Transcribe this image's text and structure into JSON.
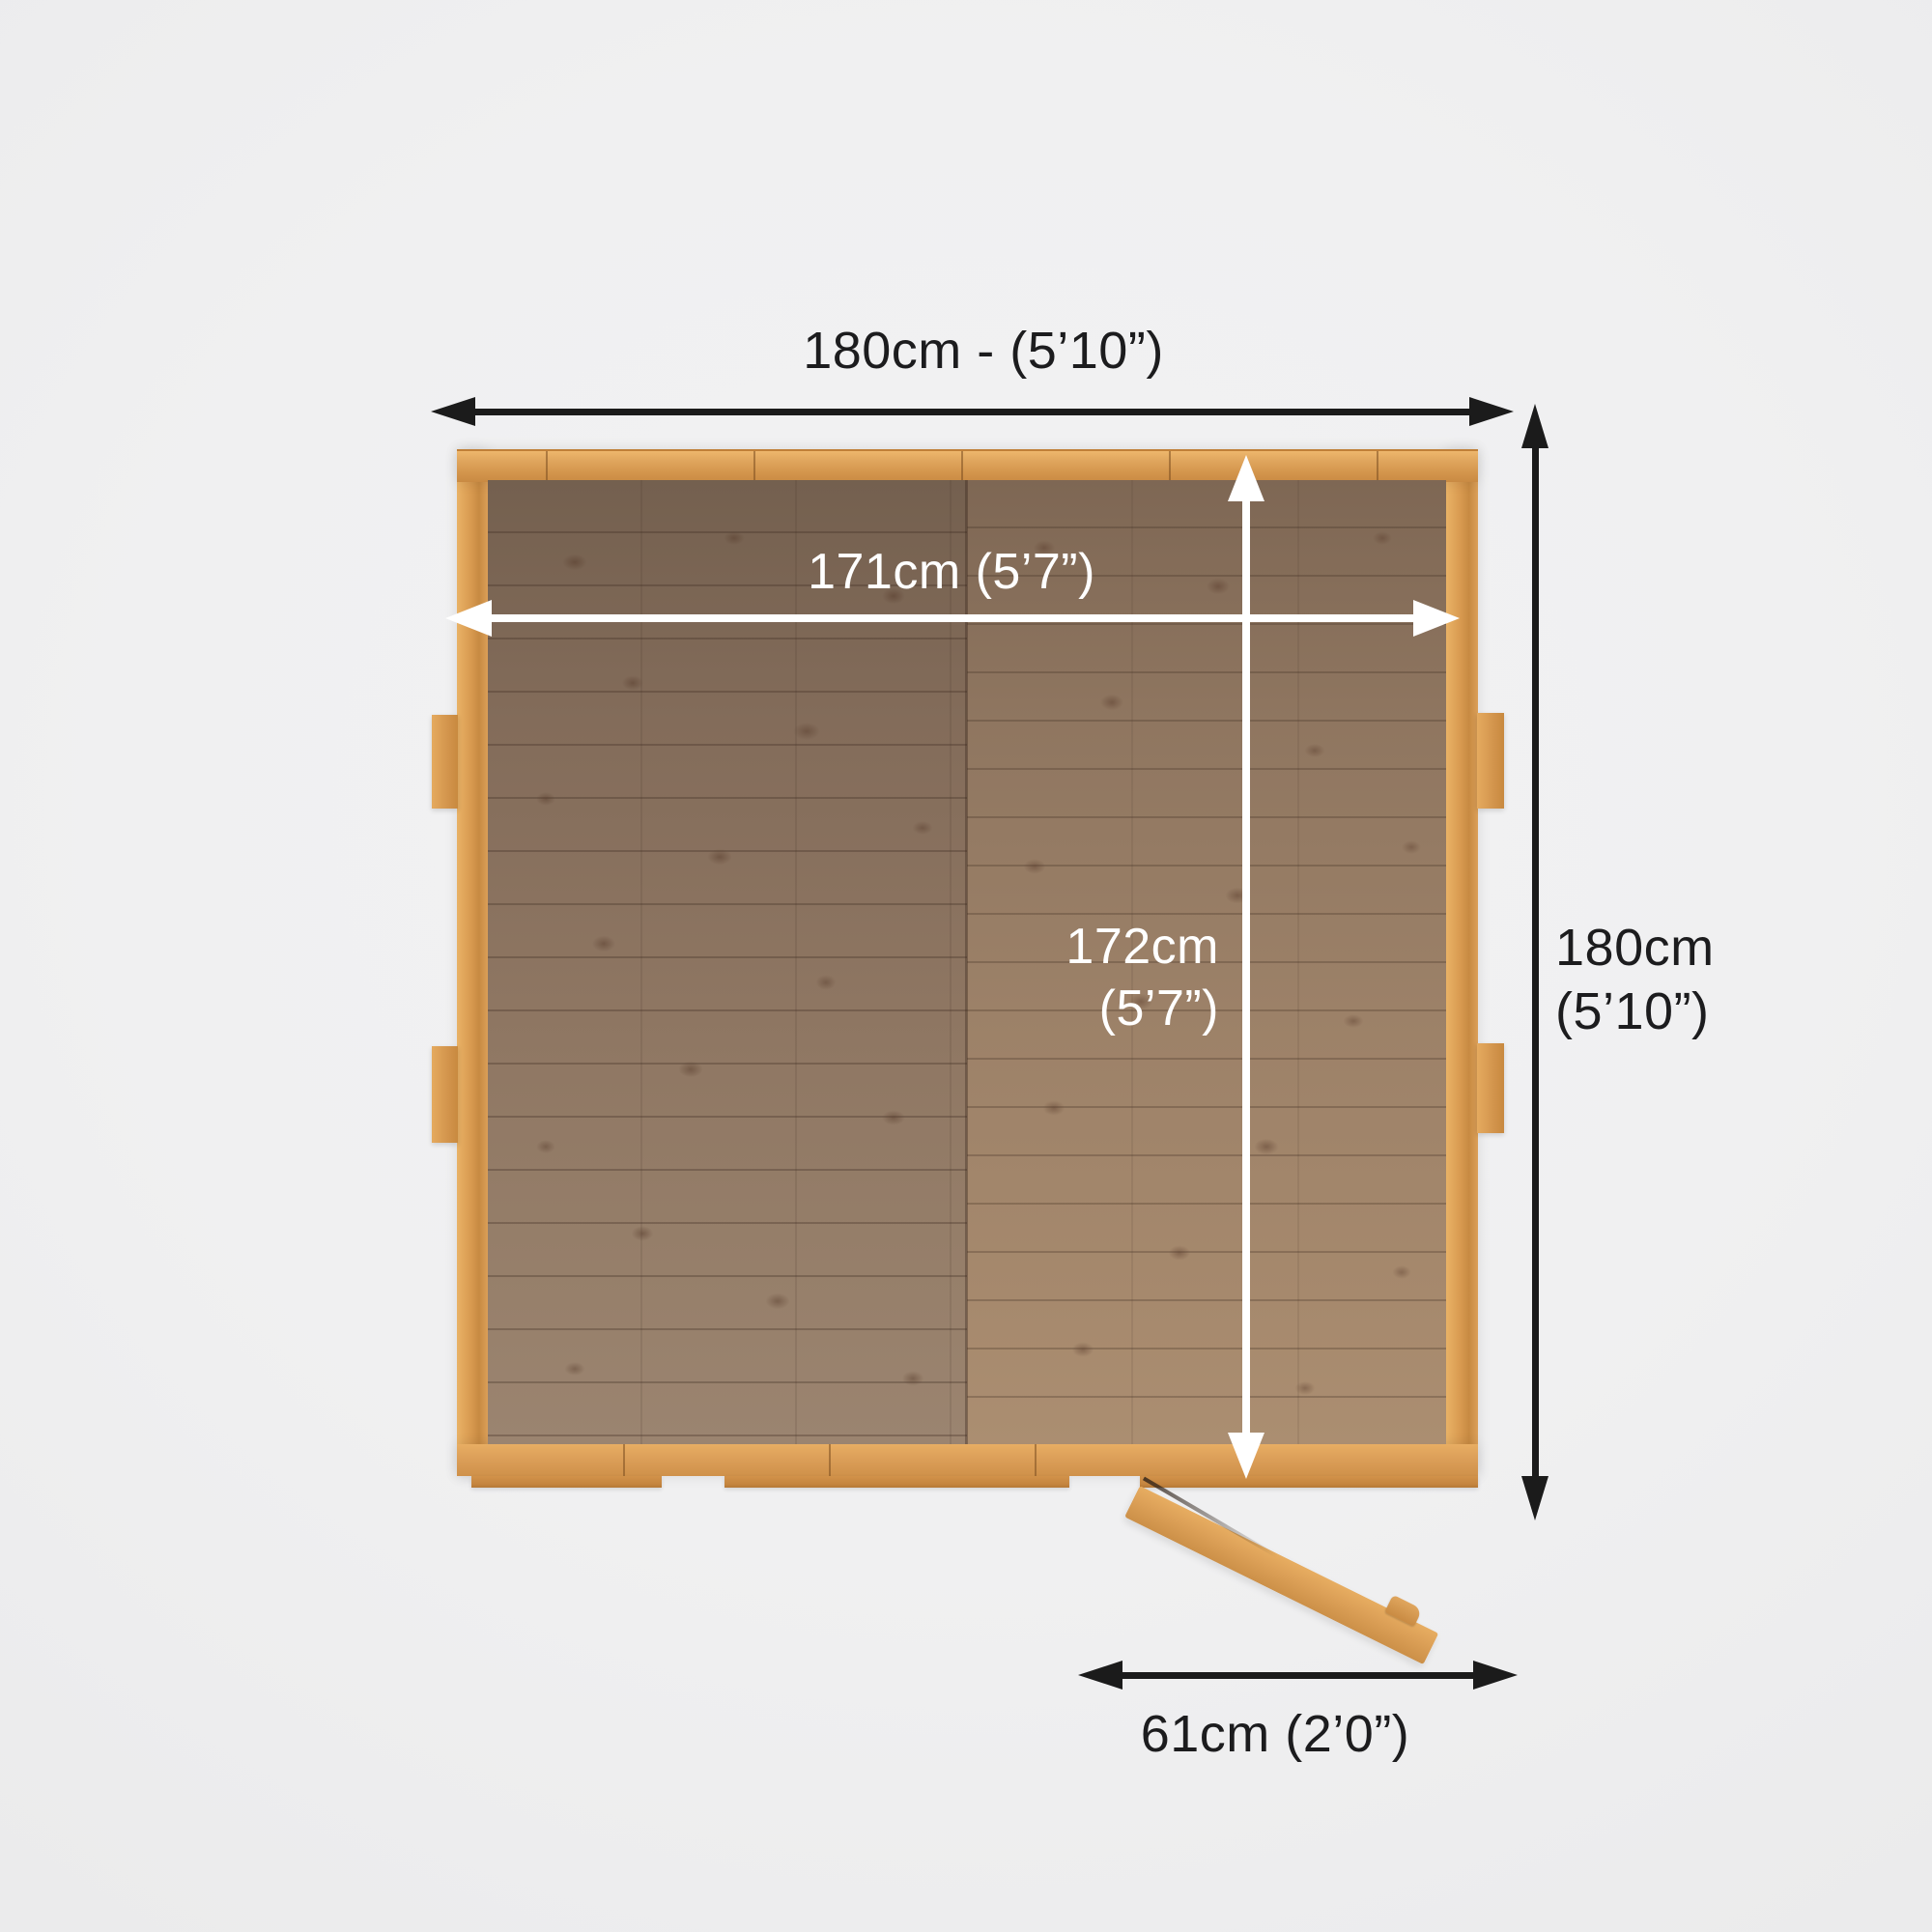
{
  "labels": {
    "external_width": "180cm - (5’10”)",
    "internal_width": "171cm  (5’7”)",
    "internal_depth": "172cm\n(5’7”)",
    "external_depth": "180cm\n(5’10”)",
    "door_width": "61cm  (2’0”)"
  },
  "colors": {
    "dimension_arrow_black": "#1b1b1b",
    "dimension_arrow_white": "#ffffff",
    "frame_wood": "#d89a50",
    "floor_wood_left": "#8e7662",
    "floor_wood_right": "#9c8168",
    "background": "#f0f0f1"
  }
}
